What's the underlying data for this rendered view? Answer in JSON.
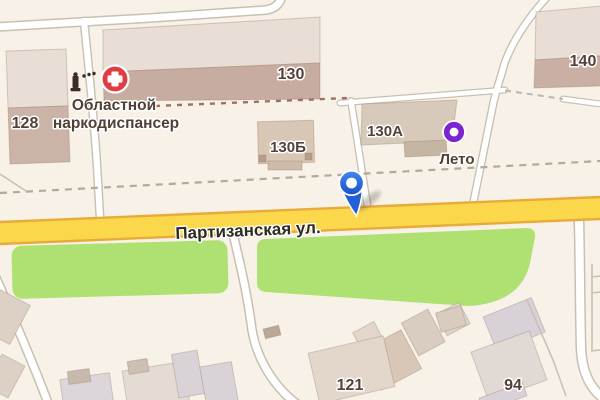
{
  "street": {
    "name": "Партизанская ул."
  },
  "buildings": {
    "b128": "128",
    "b130": "130",
    "b130b": "130Б",
    "b130a": "130А",
    "b140": "140",
    "b121": "121",
    "b94": "94"
  },
  "pois": {
    "dispensary": {
      "name": "Областной наркодиспансер",
      "line1": "Областной",
      "line2": "наркодиспансер",
      "color": "#d8393f"
    },
    "leto": {
      "label": "Лето",
      "color": "#7b24d1"
    }
  },
  "pin": {
    "color": "#2a6fe4"
  },
  "colors": {
    "background": "#f7f1e7",
    "road_main_fill": "#fbd74b",
    "road_main_casing": "#e8ab3a",
    "road_minor_fill": "#ffffff",
    "road_minor_casing": "#c8c0b2",
    "green_area": "#aee072",
    "building_light": "#e9ded6",
    "building_shadow": "#cbb3a8",
    "building_tan": "#d7c7b4",
    "dashed_path": "#b5a896",
    "fence": "#9c7164"
  }
}
